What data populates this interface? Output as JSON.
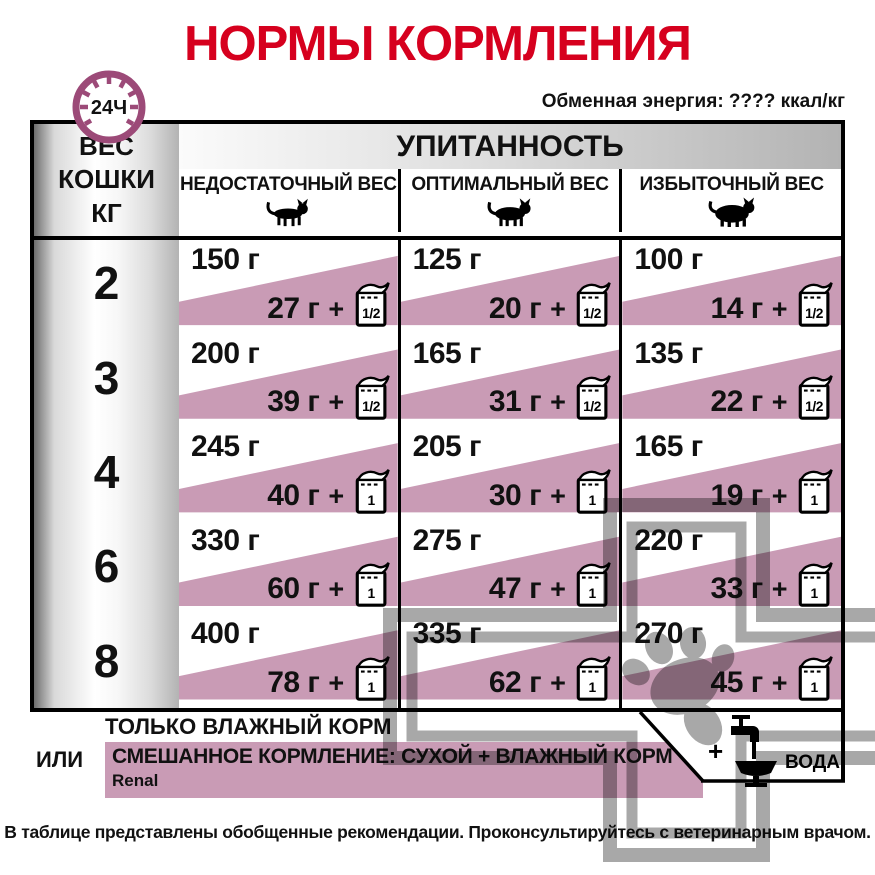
{
  "title": "НОРМЫ КОРМЛЕНИЯ",
  "energy_note": "Обменная энергия: ???? ккал/кг",
  "clock_label": "24Ч",
  "table": {
    "weight_header": "ВЕС\nКОШКИ\nКГ",
    "condition_header": "УПИТАННОСТЬ",
    "plus": "+",
    "columns": [
      {
        "label": "НЕДОСТАТОЧНЫЙ ВЕС",
        "icon": "thin-cat"
      },
      {
        "label": "ОПТИМАЛЬНЫЙ ВЕС",
        "icon": "normal-cat"
      },
      {
        "label": "ИЗБЫТОЧНЫЙ ВЕС",
        "icon": "fat-cat"
      }
    ],
    "rows": [
      {
        "weight": "2",
        "cells": [
          {
            "dry": "150 г",
            "wet": "27 г",
            "pouch": "1/2"
          },
          {
            "dry": "125 г",
            "wet": "20 г",
            "pouch": "1/2"
          },
          {
            "dry": "100 г",
            "wet": "14 г",
            "pouch": "1/2"
          }
        ]
      },
      {
        "weight": "3",
        "cells": [
          {
            "dry": "200 г",
            "wet": "39 г",
            "pouch": "1/2"
          },
          {
            "dry": "165 г",
            "wet": "31 г",
            "pouch": "1/2"
          },
          {
            "dry": "135 г",
            "wet": "22 г",
            "pouch": "1/2"
          }
        ]
      },
      {
        "weight": "4",
        "cells": [
          {
            "dry": "245 г",
            "wet": "40 г",
            "pouch": "1"
          },
          {
            "dry": "205 г",
            "wet": "30 г",
            "pouch": "1"
          },
          {
            "dry": "165 г",
            "wet": "19 г",
            "pouch": "1"
          }
        ]
      },
      {
        "weight": "6",
        "cells": [
          {
            "dry": "330 г",
            "wet": "60 г",
            "pouch": "1"
          },
          {
            "dry": "275 г",
            "wet": "47 г",
            "pouch": "1"
          },
          {
            "dry": "220 г",
            "wet": "33 г",
            "pouch": "1"
          }
        ]
      },
      {
        "weight": "8",
        "cells": [
          {
            "dry": "400 г",
            "wet": "78 г",
            "pouch": "1"
          },
          {
            "dry": "335 г",
            "wet": "62 г",
            "pouch": "1"
          },
          {
            "dry": "270 г",
            "wet": "45 г",
            "pouch": "1"
          }
        ]
      }
    ]
  },
  "footer": {
    "wet_only": "ТОЛЬКО ВЛАЖНЫЙ КОРМ",
    "or": "ИЛИ",
    "mixed": "СМЕШАННОЕ КОРМЛЕНИЕ: СУХОЙ + ВЛАЖНЫЙ КОРМ",
    "product": "Renal",
    "water_plus": "+",
    "water": "ВОДА"
  },
  "disclaimer": "В таблице представлены обобщенные рекомендации. Проконсультируйтесь с ветеринарным врачом.",
  "colors": {
    "accent_red": "#d6001e",
    "pink": "#c99bb5",
    "clock_purple": "#9c4a78",
    "watermark_gray": "#a8a8a8"
  }
}
